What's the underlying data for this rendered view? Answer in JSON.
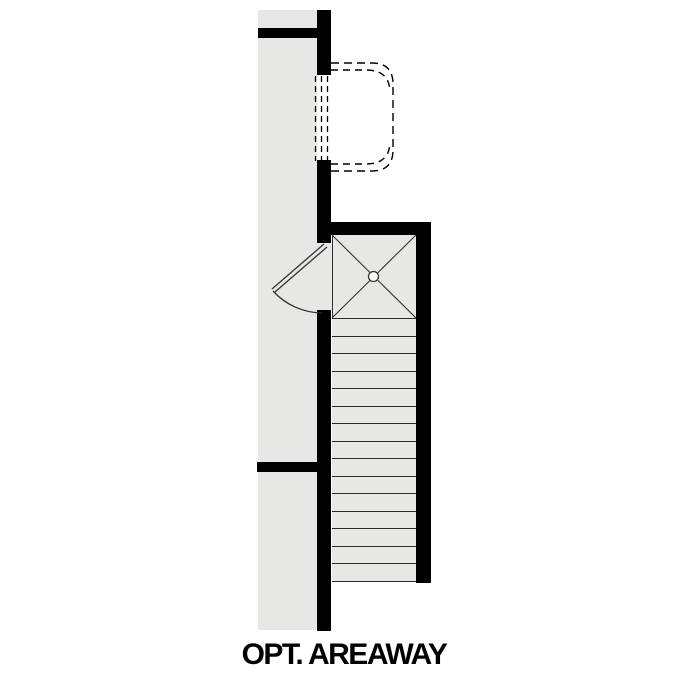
{
  "title": {
    "label": "OPT. AREAWAY"
  },
  "colors": {
    "wall": "#000000",
    "floor": "#e7e7e5",
    "line": "#2b2b2b",
    "background": "#ffffff"
  },
  "plan": {
    "stairs": {
      "tread_count": 15
    }
  }
}
